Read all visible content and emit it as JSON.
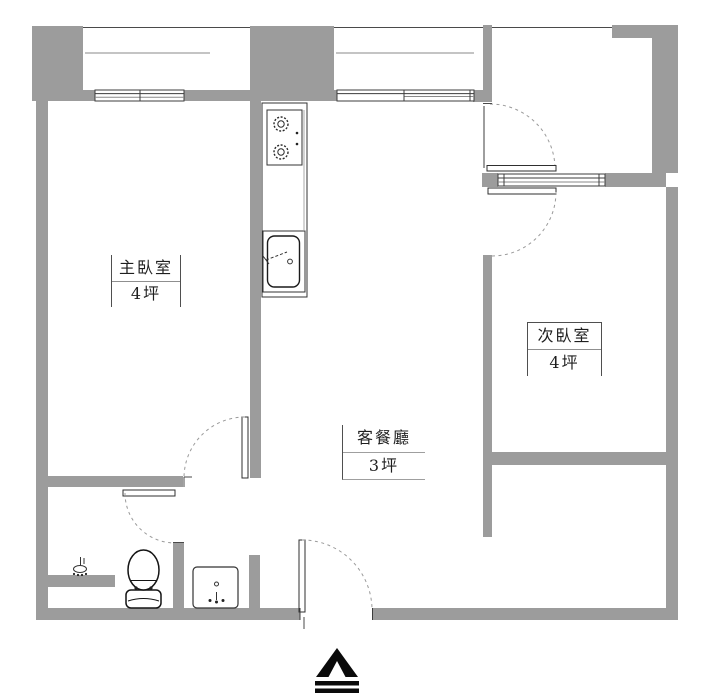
{
  "drawing": {
    "type": "apartment-floor-plan",
    "units_note": "坪 (ping) area labels as shown on plan"
  },
  "rooms": [
    {
      "id": "master-bedroom",
      "name": "主臥室",
      "area": "4坪"
    },
    {
      "id": "second-bedroom",
      "name": "次臥室",
      "area": "4坪"
    },
    {
      "id": "living-dining",
      "name": "客餐廳",
      "area": "3坪"
    }
  ],
  "fixtures": [
    "stove-two-burner",
    "kitchen-sink",
    "kitchen-counter",
    "toilet",
    "wash-basin",
    "shower-head"
  ],
  "compass": {
    "type": "north-arrow"
  },
  "colors": {
    "wall": "#9c9c9c",
    "outline": "#3c3c3c",
    "door_arc": "#9a9a9a",
    "text": "#1f1f1f",
    "background": "#ffffff"
  }
}
